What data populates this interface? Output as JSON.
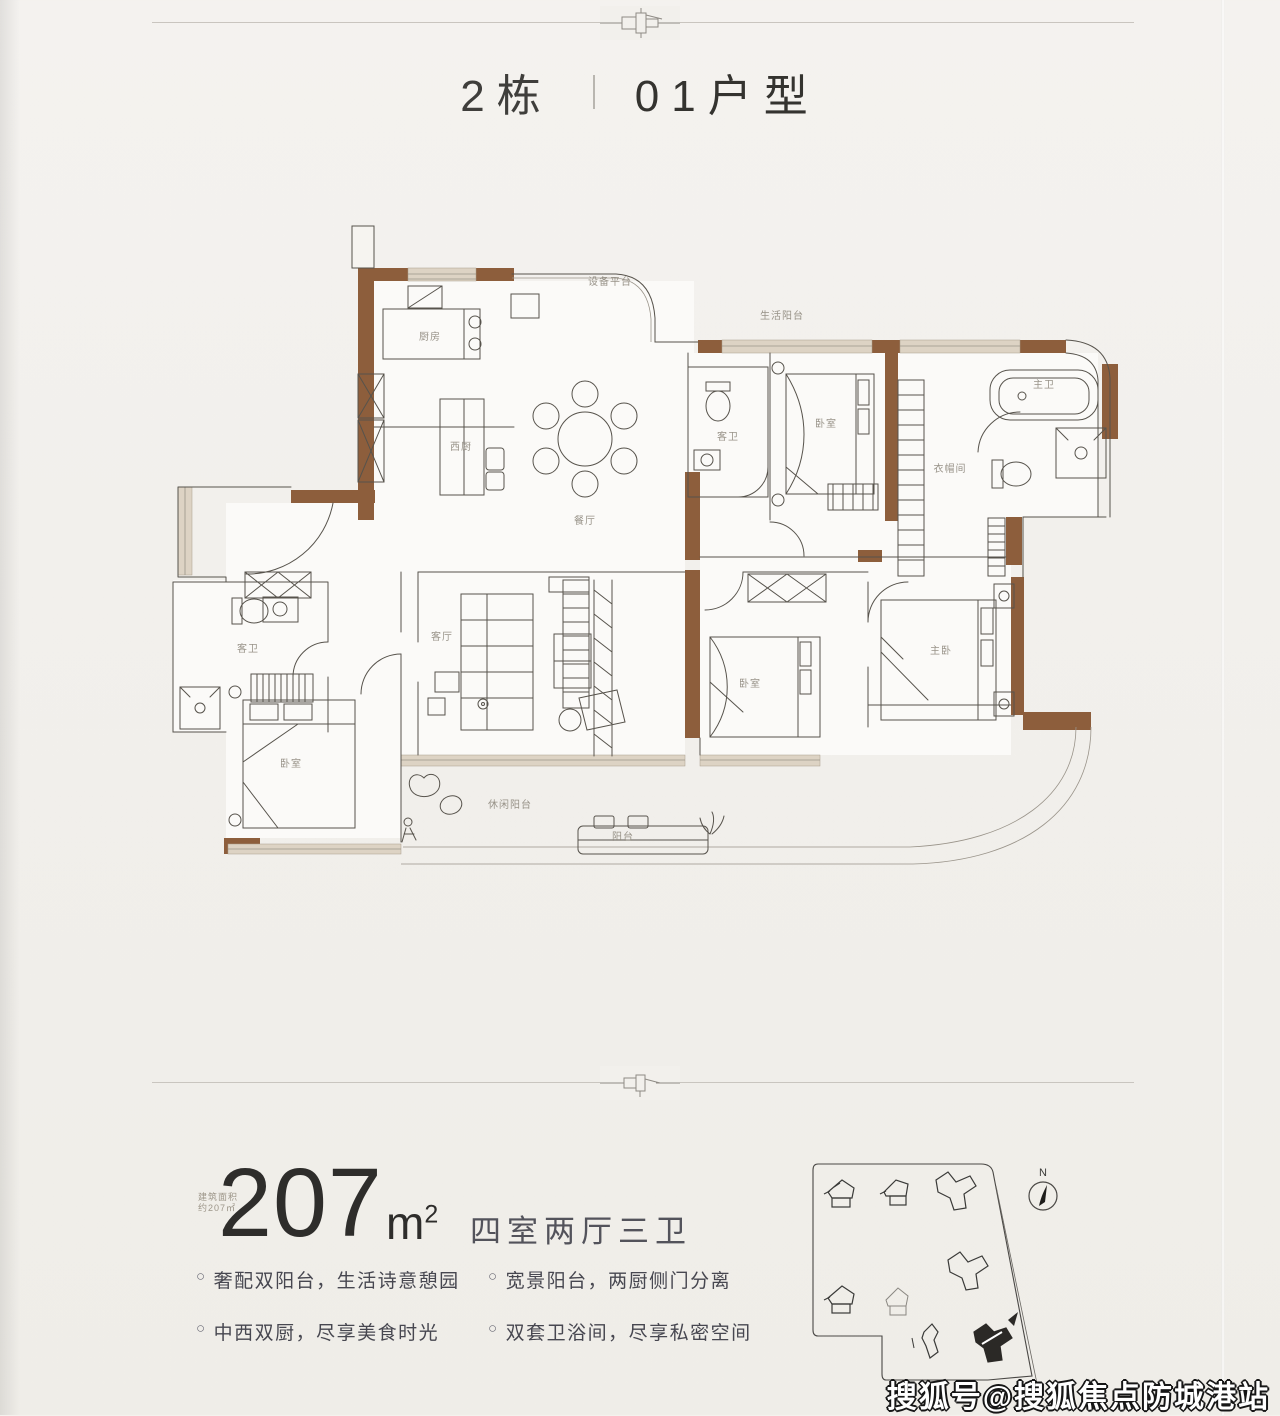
{
  "header": {
    "building": "2栋",
    "unit": "01户型"
  },
  "area": {
    "stamp_line1": "建筑面积",
    "stamp_line2": "约207㎡",
    "value": "207",
    "unit_base": "m",
    "unit_sup": "2",
    "layout": "四室两厅三卫"
  },
  "features": {
    "bullet": "○",
    "items": [
      "奢配双阳台，生活诗意憩园",
      "宽景阳台，两厨侧门分离",
      "中西双厨，尽享美食时光",
      "双套卫浴间，尽享私密空间"
    ]
  },
  "floor_plan": {
    "room_labels": [
      {
        "text": "厨房",
        "x": 272,
        "y": 118
      },
      {
        "text": "设备平台",
        "x": 452,
        "y": 63
      },
      {
        "text": "生活阳台",
        "x": 624,
        "y": 97
      },
      {
        "text": "西厨",
        "x": 303,
        "y": 228
      },
      {
        "text": "餐厅",
        "x": 427,
        "y": 302
      },
      {
        "text": "客卫",
        "x": 570,
        "y": 218
      },
      {
        "text": "卧室",
        "x": 668,
        "y": 205
      },
      {
        "text": "衣帽间",
        "x": 792,
        "y": 250
      },
      {
        "text": "主卫",
        "x": 886,
        "y": 166
      },
      {
        "text": "客卫",
        "x": 90,
        "y": 430
      },
      {
        "text": "卧室",
        "x": 133,
        "y": 545
      },
      {
        "text": "客厅",
        "x": 284,
        "y": 418
      },
      {
        "text": "卧室",
        "x": 592,
        "y": 465
      },
      {
        "text": "主卧",
        "x": 783,
        "y": 432
      },
      {
        "text": "休闲阳台",
        "x": 352,
        "y": 586
      },
      {
        "text": "阳台",
        "x": 465,
        "y": 618
      }
    ]
  },
  "site_map": {
    "north_label": "N"
  },
  "watermark": {
    "text": "搜狐号@搜狐焦点防城港站"
  },
  "colors": {
    "wall_brown": "#8d5e3c",
    "wall_light": "#ddd3c4",
    "line": "#57534c",
    "paper": "#f1efeb",
    "highlight_building": "#2b2926"
  }
}
